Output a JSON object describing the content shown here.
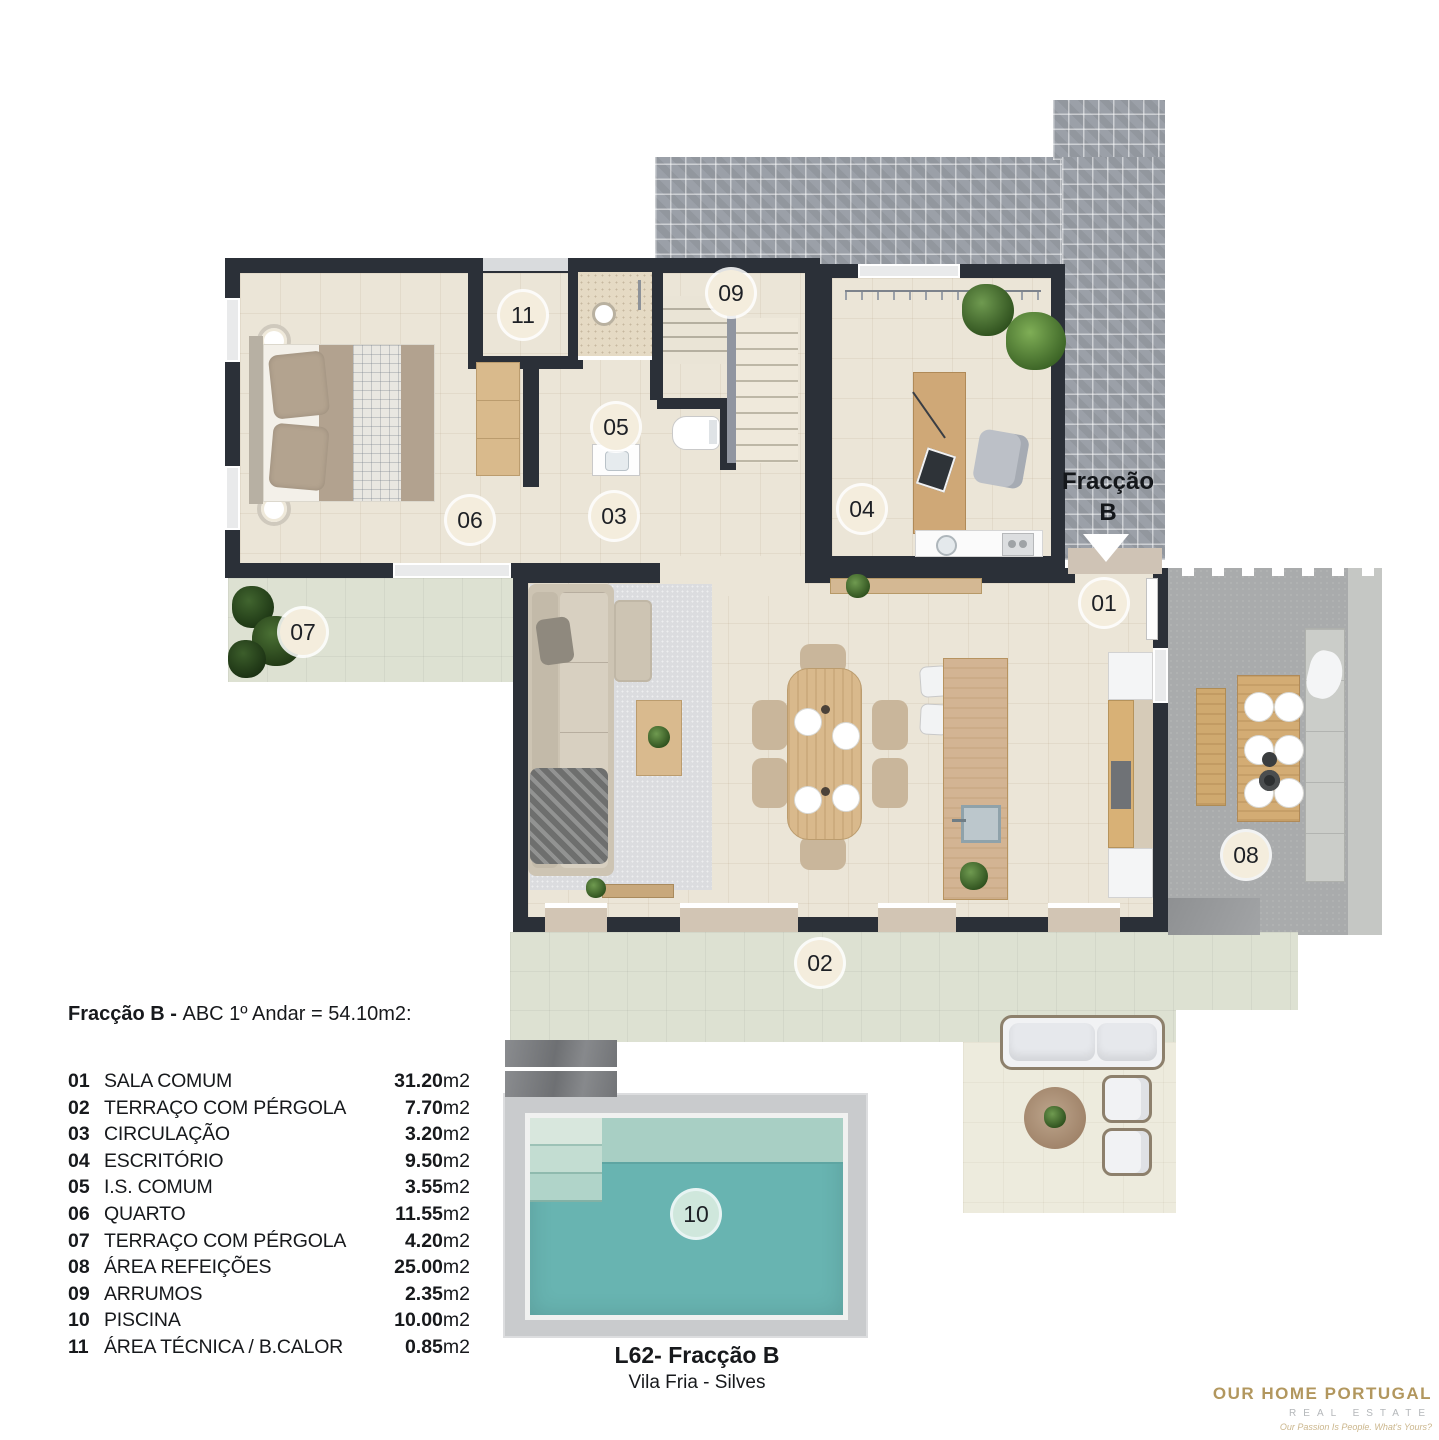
{
  "plan": {
    "entrance_label_line1": "Fracção",
    "entrance_label_line2": "B",
    "badges": [
      {
        "num": "01",
        "x": 1104,
        "y": 603
      },
      {
        "num": "02",
        "x": 820,
        "y": 963
      },
      {
        "num": "03",
        "x": 614,
        "y": 516
      },
      {
        "num": "04",
        "x": 862,
        "y": 509
      },
      {
        "num": "05",
        "x": 616,
        "y": 427
      },
      {
        "num": "06",
        "x": 470,
        "y": 520
      },
      {
        "num": "07",
        "x": 303,
        "y": 632
      },
      {
        "num": "08",
        "x": 1246,
        "y": 855
      },
      {
        "num": "09",
        "x": 731,
        "y": 293
      },
      {
        "num": "10",
        "x": 696,
        "y": 1214,
        "variant": "pool"
      },
      {
        "num": "11",
        "x": 523,
        "y": 315
      }
    ]
  },
  "legend": {
    "header_bold": "Fracção B - ",
    "header_rest": "ABC 1º Andar = 54.10m2:",
    "items": [
      {
        "num": "01",
        "name": "SALA COMUM",
        "area": "31.20",
        "unit": " m2"
      },
      {
        "num": "02",
        "name": "TERRAÇO COM PÉRGOLA",
        "area": "7.70",
        "unit": " m2"
      },
      {
        "num": "03",
        "name": "CIRCULAÇÃO",
        "area": "3.20",
        "unit": " m2"
      },
      {
        "num": "04",
        "name": "ESCRITÓRIO",
        "area": "9.50",
        "unit": " m2"
      },
      {
        "num": "05",
        "name": "I.S. COMUM",
        "area": "3.55",
        "unit": " m2"
      },
      {
        "num": "06",
        "name": "QUARTO",
        "area": "11.55",
        "unit": " m2"
      },
      {
        "num": "07",
        "name": "TERRAÇO COM PÉRGOLA",
        "area": "4.20",
        "unit": " m2"
      },
      {
        "num": "08",
        "name": "ÁREA REFEIÇÕES",
        "area": "25.00",
        "unit": " m2"
      },
      {
        "num": "09",
        "name": "ARRUMOS",
        "area": "2.35",
        "unit": " m2"
      },
      {
        "num": "10",
        "name": "PISCINA",
        "area": "10.00",
        "unit": " m2"
      },
      {
        "num": "11",
        "name": "ÁREA TÉCNICA / B.CALOR",
        "area": "0.85",
        "unit": " m2"
      }
    ]
  },
  "footer": {
    "title": "L62- Fracção B",
    "subtitle": "Vila Fria - Silves"
  },
  "logo": {
    "name": "OUR HOME PORTUGAL",
    "sub": "REAL ESTATE",
    "tagline": "Our Passion Is People. What's Yours?"
  },
  "colors": {
    "wall": "#2b3038",
    "floor": "#ebe5d7",
    "terrace_sage": "#dde1d2",
    "lounge_cream": "#edebdd",
    "pool_water": "#68b4b1",
    "pool_shallow": "#a8cfc4",
    "pool_deck": "#c9cbcd",
    "concrete": "#a9abac",
    "brick": "#9ba0a8",
    "wood": "#d3ac74",
    "badge_bg": "#f4eddd",
    "badge_pool_bg": "#cfe7dc",
    "logo_gold": "#b2975e"
  }
}
